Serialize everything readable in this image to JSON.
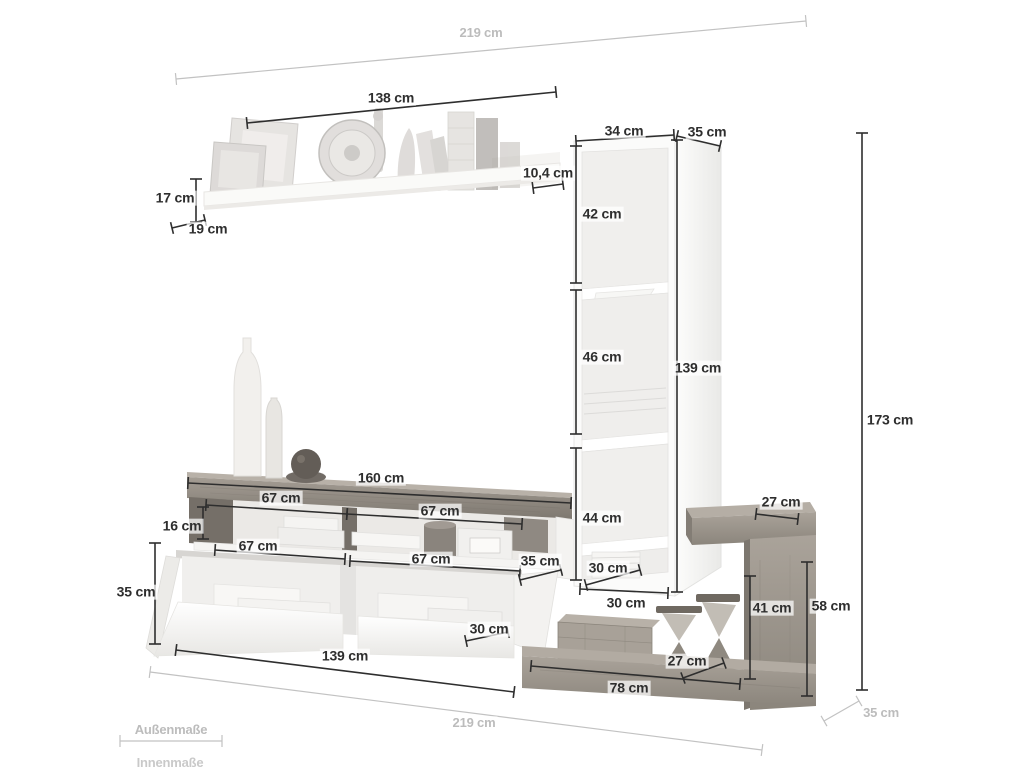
{
  "colors": {
    "dim_dark": "#2e2e2e",
    "dim_gray": "#c2c2c2",
    "wood": "#9b948b",
    "white_furniture": "#fbfbfa"
  },
  "legend": {
    "outer_label": "Außenmaße",
    "inner_label": "Innenmaße"
  },
  "dims": {
    "total_width_top": "219 cm",
    "total_width_bottom": "219 cm",
    "total_height": "173 cm",
    "total_depth": "35 cm",
    "shelf_width": "138 cm",
    "shelf_height": "17 cm",
    "shelf_depth": "19 cm",
    "shelf_board_depth": "10,4 cm",
    "column_width": "34 cm",
    "column_depth": "35 cm",
    "column_sec_1": "42 cm",
    "column_sec_2": "46 cm",
    "column_sec_3": "44 cm",
    "column_height": "139 cm",
    "column_inner_width": "30 cm",
    "column_outer_width": "30 cm",
    "bench_width": "160 cm",
    "bench_open_left": "67 cm",
    "bench_open_right": "67 cm",
    "bench_inner_height": "16 cm",
    "bench_depth": "35 cm",
    "lowboard_flap_left": "67 cm",
    "lowboard_flap_right": "67 cm",
    "lowboard_height": "35 cm",
    "lowboard_inner_height": "30 cm",
    "lowboard_width": "139 cm",
    "side_top_depth": "27 cm",
    "side_inner_height": "41 cm",
    "side_height": "58 cm",
    "side_shelf_depth": "27 cm",
    "side_shelf_width": "78 cm"
  }
}
